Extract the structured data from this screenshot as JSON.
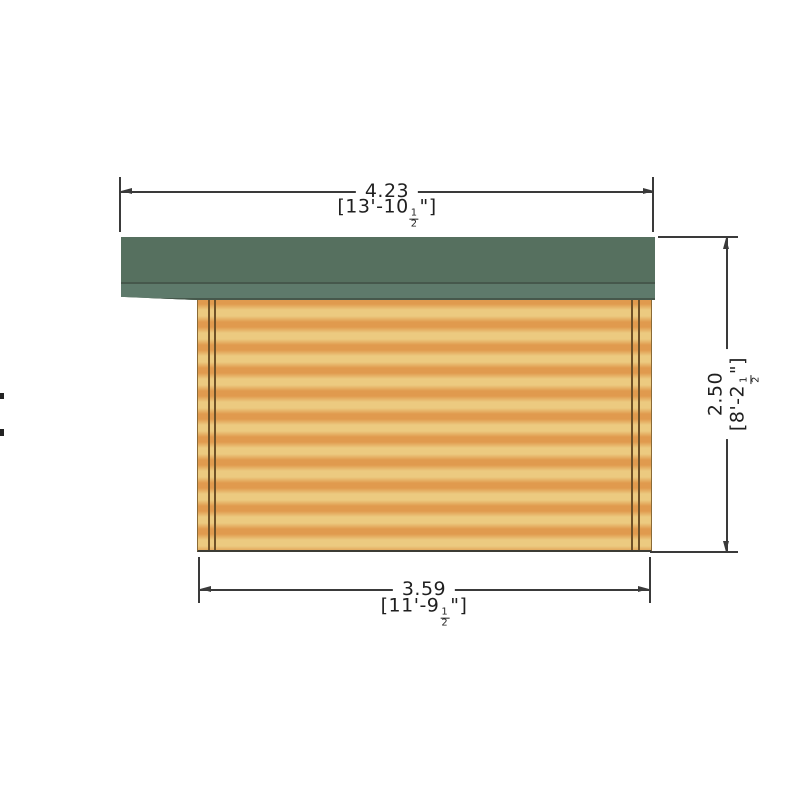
{
  "colors": {
    "background": "#ffffff",
    "roof-main": "#56705f",
    "roof-fascia": "#5e7a6b",
    "roof-edge": "#46584c",
    "wall-light": "#ecca80",
    "wall-stripe": "#e09a4e",
    "post-line": "#6e5128",
    "wall-edge": "#8a6a35",
    "wall-base": "#3c3c35",
    "dim-line": "#3a3a3a",
    "text": "#1f1f1f"
  },
  "dimensions": {
    "top": {
      "metric": "4.23",
      "imperial_prefix": "[13'-10",
      "fraction_numerator": "1",
      "fraction_denominator": "2",
      "imperial_suffix": "\"]"
    },
    "right": {
      "metric": "2.50",
      "imperial_prefix": "[8'-2",
      "fraction_numerator": "1",
      "fraction_denominator": "2",
      "imperial_suffix": "\"]"
    },
    "bottom": {
      "metric": "3.59",
      "imperial_prefix": "[11'-9",
      "fraction_numerator": "1",
      "fraction_denominator": "2",
      "imperial_suffix": "\"]"
    }
  }
}
